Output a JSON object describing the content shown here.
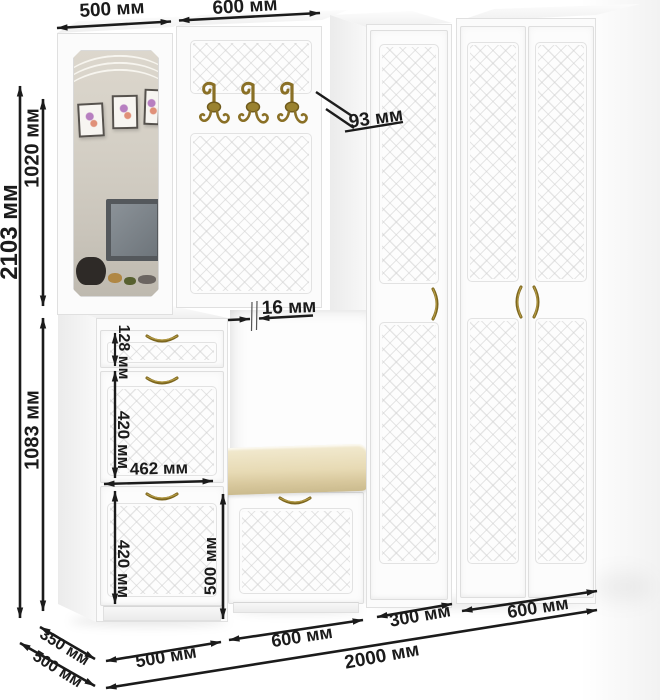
{
  "diagram": {
    "unit": "мм"
  },
  "dims": {
    "top_left_width": "500 мм",
    "top_right_width": "600 мм",
    "left_total_height": "2103 мм",
    "left_upper_height": "1020 мм",
    "left_lower_height": "1083 мм",
    "hook_offset": "93 мм",
    "panel_thickness": "16 мм",
    "drawer_height": "128 мм",
    "upper_flap_height": "420 мм",
    "flap_width": "462 мм",
    "lower_flap_height": "420 мм",
    "bench_height": "500 мм",
    "depth_top": "350 мм",
    "depth_bottom": "500 мм",
    "bottom_shoe_width": "500 мм",
    "bottom_bench_width": "600 мм",
    "bottom_single_wardrobe_width": "300 мм",
    "bottom_double_wardrobe_width": "600 мм",
    "bottom_total_width": "2000 мм"
  },
  "colors": {
    "dimension_line": "#1b1b1b",
    "furniture_white": "#fbfbfb",
    "panel_outline": "#e0e0e0",
    "cushion_beige": "#e6d9b2",
    "brass_gold": "#8a7026",
    "mirror_wall": "#d5d0c6"
  },
  "icons": {
    "coat_hook": "brass-double-hook",
    "door_handle": "brass-arc-handle"
  }
}
